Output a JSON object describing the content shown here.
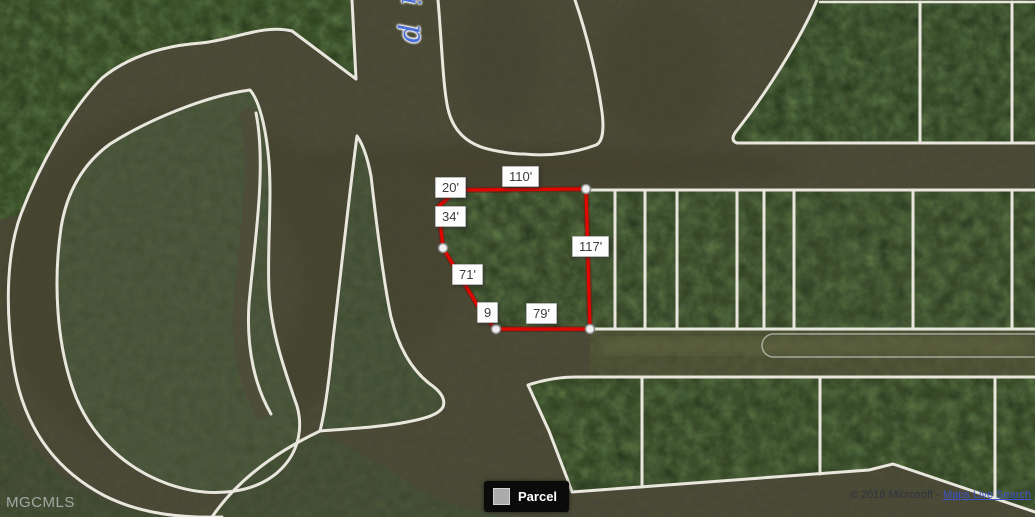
{
  "map": {
    "provider_watermark": "MGCMLS",
    "copyright": {
      "prefix": "© 2018 Microsoft - ",
      "link_text": "Maps Live Search"
    },
    "water_label": {
      "letter_top": "i",
      "letter_bottom": "p"
    },
    "legend": {
      "items": [
        {
          "label": "Parcel",
          "swatch_color": "#ababab"
        }
      ]
    },
    "parcel": {
      "outline_color": "#e10600",
      "measurements": [
        {
          "side": "northwest-jog",
          "text": "20'"
        },
        {
          "side": "north",
          "text": "110'"
        },
        {
          "side": "west-upper",
          "text": "34'"
        },
        {
          "side": "east",
          "text": "117'"
        },
        {
          "side": "west-lower",
          "text": "71'"
        },
        {
          "side": "south-jog",
          "text": "9"
        },
        {
          "side": "south",
          "text": "79'"
        }
      ]
    },
    "colors": {
      "water": "#4e4d3a",
      "trees": "#3e5136",
      "boundary_line": "#efece3",
      "parcel_line": "#e10600",
      "water_label_text": "#4a6fd8"
    }
  }
}
